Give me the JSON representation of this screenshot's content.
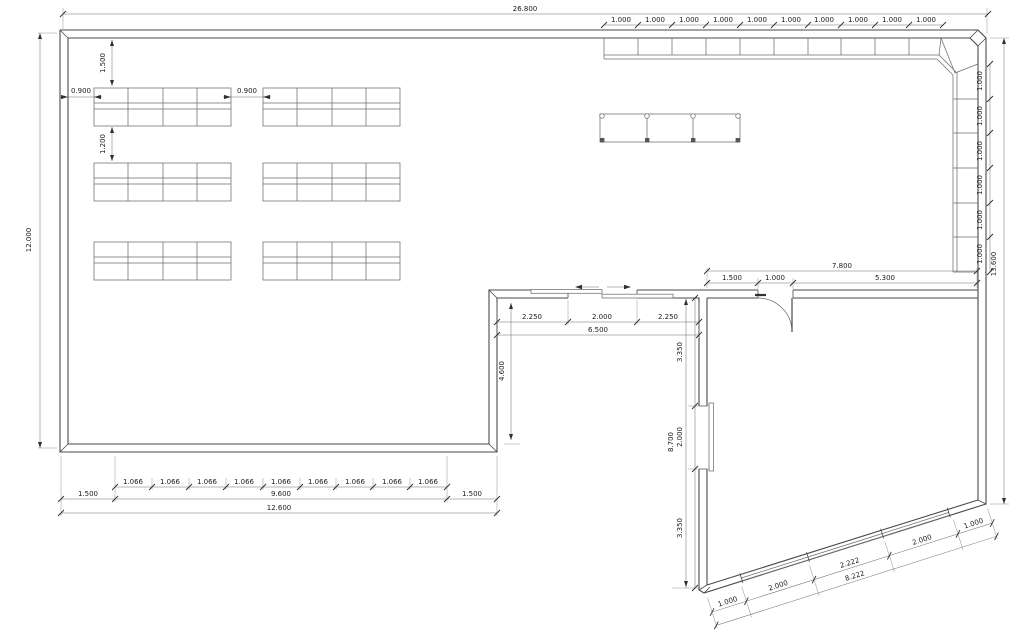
{
  "drawing": {
    "dims": {
      "overall_width": "26.800",
      "left_height": "12.000",
      "right_height": "13.600",
      "top_counter_units": [
        "1.000",
        "1.000",
        "1.000",
        "1.000",
        "1.000",
        "1.000",
        "1.000",
        "1.000",
        "1.000",
        "1.000"
      ],
      "right_counter_units": [
        "1.000",
        "1.000",
        "1.000",
        "1.000",
        "1.000",
        "1.000"
      ],
      "shelf_top_offset": "1.500",
      "shelf_row_gap": "1.200",
      "shelf_left_gap": "0.900",
      "shelf_mid_gap": "0.900",
      "entry_left": "2.250",
      "entry_opening": "2.000",
      "entry_right": "2.250",
      "entry_total": "6.500",
      "entry_depth": "4.600",
      "west_upper": "3.350",
      "west_opening": "2.000",
      "west_lower": "3.350",
      "west_total": "8.700",
      "north_room_total": "7.800",
      "door_left": "1.500",
      "door_opening": "1.000",
      "door_right": "5.300",
      "south_segments": [
        "1.066",
        "1.066",
        "1.066",
        "1.066",
        "1.066",
        "1.066",
        "1.066",
        "1.066",
        "1.066"
      ],
      "south_margin_left": "1.500",
      "south_span": "9.600",
      "south_margin_right": "1.500",
      "south_total": "12.600",
      "diag_segments": [
        "1.000",
        "2.000",
        "2.222",
        "2.000",
        "1.000"
      ],
      "diag_total": "8.222"
    }
  }
}
